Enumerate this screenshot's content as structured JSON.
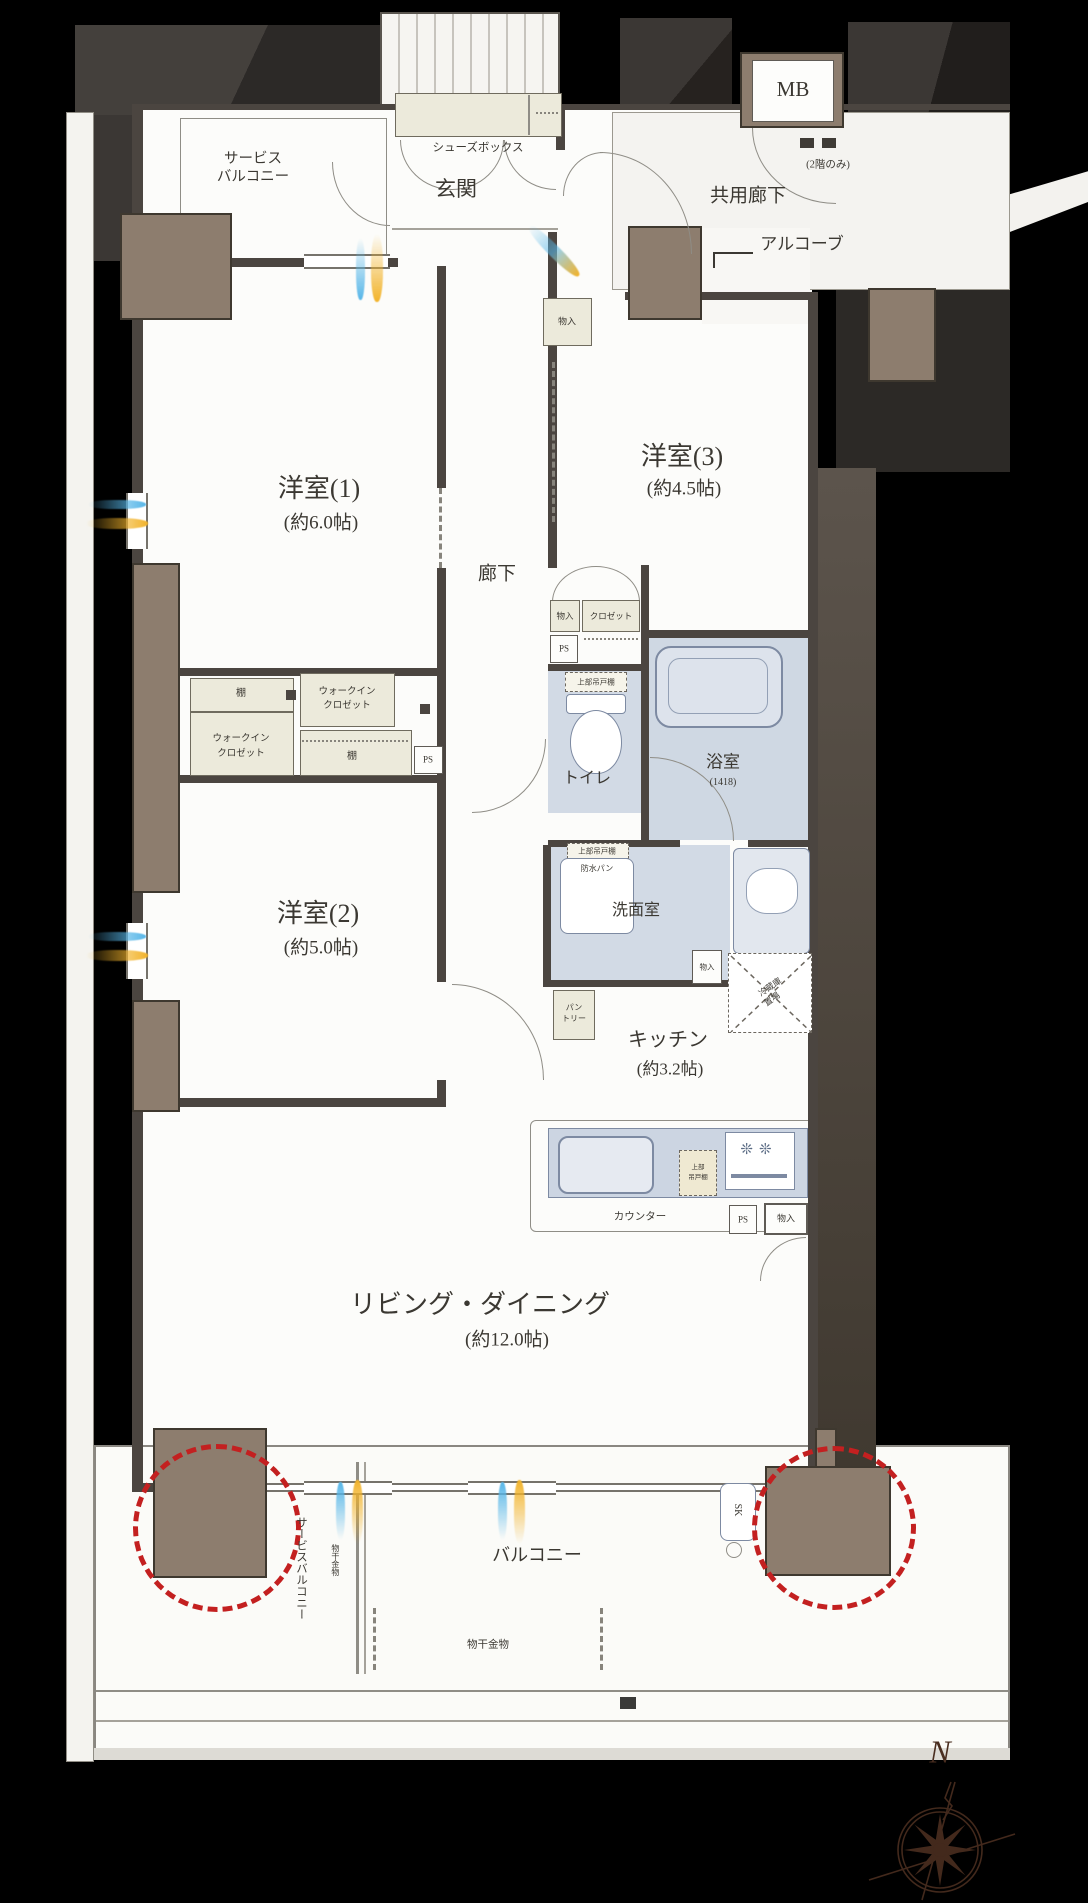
{
  "plan": {
    "common": {
      "mb": "MB",
      "second_floor_only": "(2階のみ)",
      "shared_corridor": "共用廊下",
      "alcove": "アルコーブ"
    },
    "entrance": {
      "name": "玄関",
      "shoe_box": "シューズボックス"
    },
    "rooms": {
      "bedroom1": {
        "name": "洋室(1)",
        "size": "(約6.0帖)"
      },
      "bedroom2": {
        "name": "洋室(2)",
        "size": "(約5.0帖)"
      },
      "bedroom3": {
        "name": "洋室(3)",
        "size": "(約4.5帖)"
      },
      "living": {
        "name": "リビング・ダイニング",
        "size": "(約12.0帖)"
      },
      "kitchen": {
        "name": "キッチン",
        "size": "(約3.2帖)"
      },
      "bath": {
        "name": "浴室",
        "size": "(1418)"
      },
      "toilet": {
        "name": "トイレ"
      },
      "washroom": {
        "name": "洗面室"
      },
      "hallway": {
        "name": "廊下"
      }
    },
    "storage": {
      "walk_in_closet_line1": "ウォークイン",
      "walk_in_closet_line2": "クロゼット",
      "closet": "クロゼット",
      "storage_small": "物入",
      "shelf": "棚",
      "pantry_line1": "パン",
      "pantry_line2": "トリー",
      "fridge_space_line1": "冷蔵庫",
      "fridge_space_line2": "置場",
      "upper_cabinet": "上部吊戸棚",
      "upper_cabinet_line1": "上部",
      "upper_cabinet_line2": "吊戸棚"
    },
    "fixtures": {
      "counter": "カウンター",
      "pipe_space": "PS",
      "slop_sink": "SK",
      "waterproof_pan": "防水パン"
    },
    "outdoor": {
      "balcony": "バルコニー",
      "service_balcony_line1": "サービス",
      "service_balcony_line2": "バルコニー",
      "service_balcony": "サービスバルコニー",
      "laundry_hardware": "物干金物"
    },
    "compass_north": "N"
  }
}
